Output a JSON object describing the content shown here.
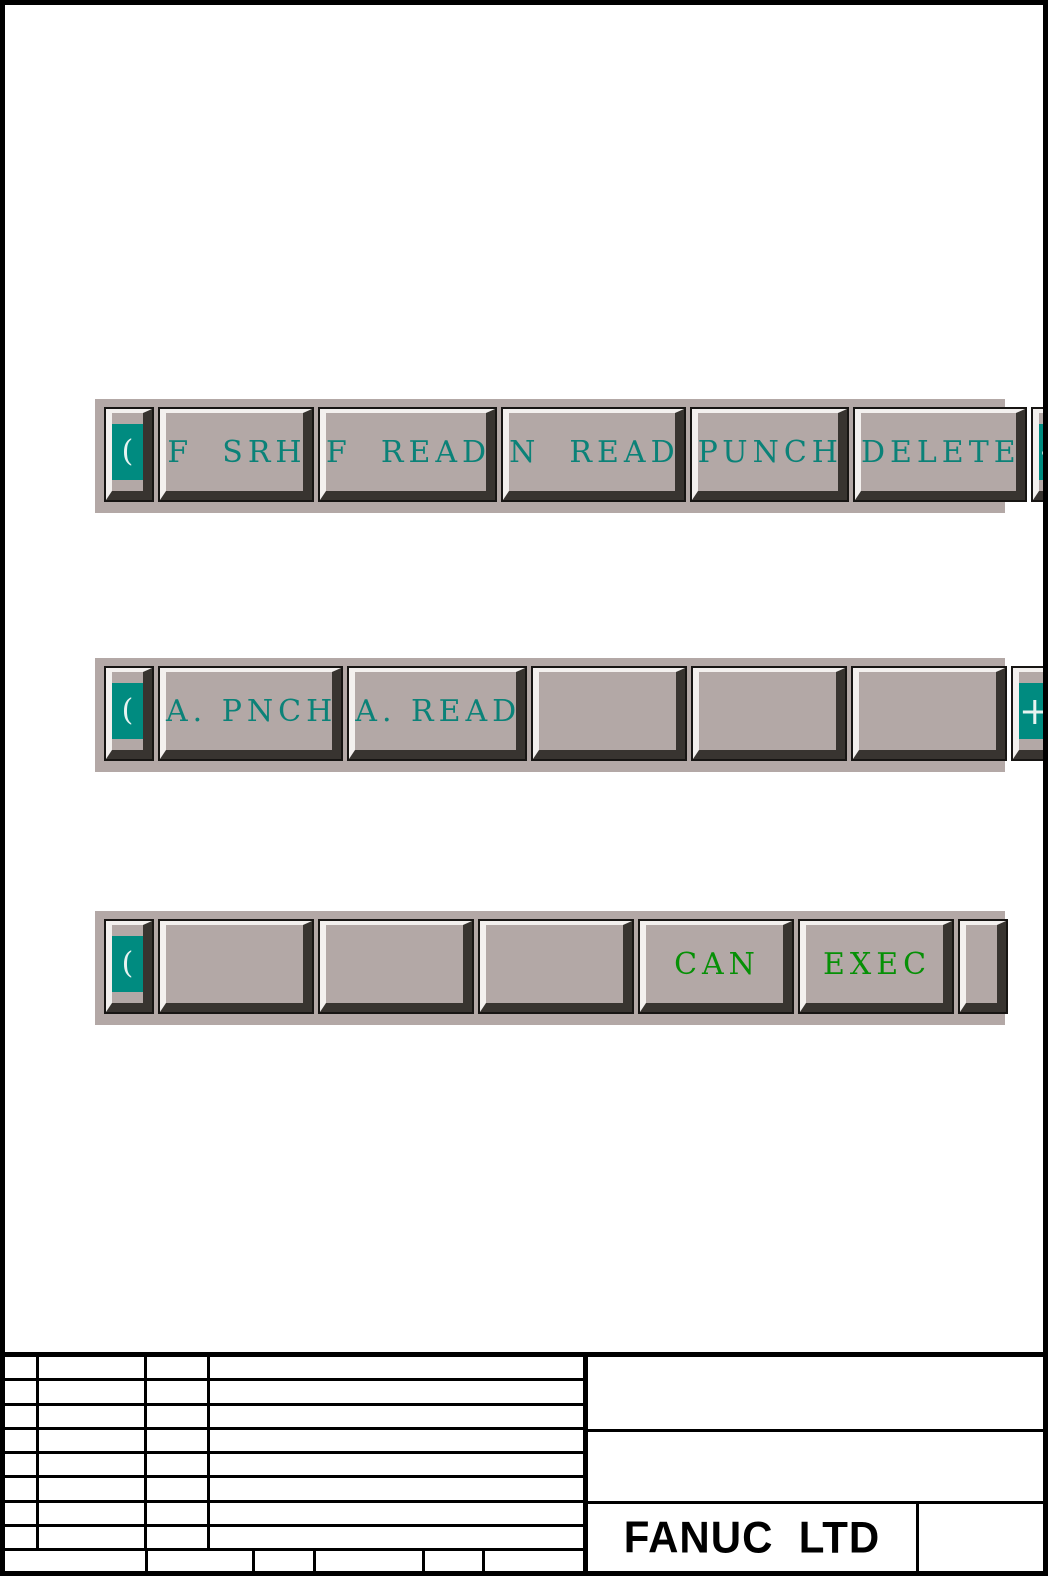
{
  "colors": {
    "bar_background": "#b3a8a6",
    "button_face": "#b3a8a6",
    "bevel_light": "#f3f0ee",
    "bevel_dark": "#383430",
    "button_outline": "#171513",
    "softkey_label_teal": "#0b8278",
    "softkey_label_green": "#069006",
    "nav_glyph_background": "#008b80",
    "nav_glyph_color": "#e7f3f1",
    "line_color": "#000000",
    "page_background": "#ffffff"
  },
  "bars": [
    {
      "prev": "(",
      "next": "+",
      "keys": [
        "F  SRH",
        "F  READ",
        "N  READ",
        "PUNCH",
        "DELETE"
      ]
    },
    {
      "prev": "(",
      "next": "+",
      "keys": [
        "A. PNCH",
        "A. READ",
        "",
        "",
        ""
      ]
    },
    {
      "prev": "(",
      "next": "",
      "keys": [
        "",
        "",
        "",
        "CAN",
        "EXEC"
      ]
    }
  ],
  "titleblock": {
    "company": "FANUC  LTD"
  }
}
